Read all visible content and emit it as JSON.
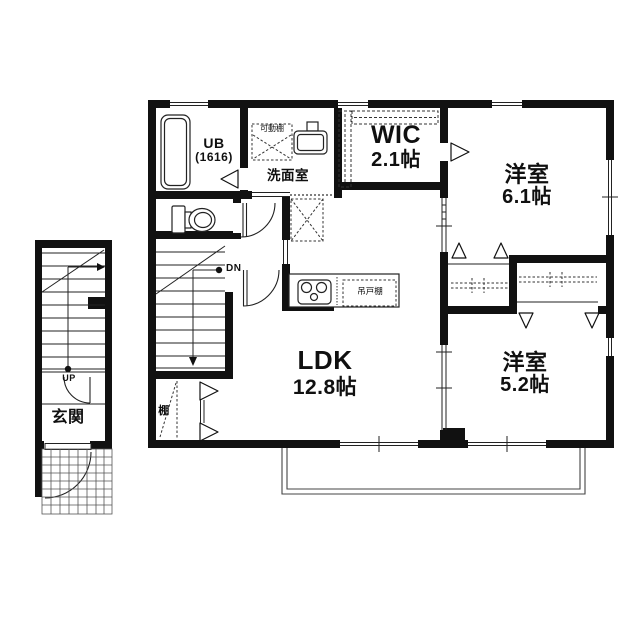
{
  "plan": {
    "type": "floor-plan",
    "colors": {
      "wall": "#111111",
      "line": "#222222",
      "dash": "#333333",
      "bg": "#ffffff"
    }
  },
  "rooms": {
    "ub": {
      "label": "UB",
      "size": "(1616)"
    },
    "washroom": {
      "label": "洗面室"
    },
    "wic": {
      "label": "WIC",
      "size": "2.1帖"
    },
    "bedroom1": {
      "label": "洋室",
      "size": "6.1帖"
    },
    "bedroom2": {
      "label": "洋室",
      "size": "5.2帖"
    },
    "ldk": {
      "label": "LDK",
      "size": "12.8帖"
    },
    "entrance": {
      "label": "玄関"
    }
  },
  "fixtures": {
    "movable_shelf": "可動棚",
    "hanging_cupboard": "吊戸棚",
    "shelf": "棚"
  },
  "stairs": {
    "down": "DN",
    "up": "UP"
  }
}
